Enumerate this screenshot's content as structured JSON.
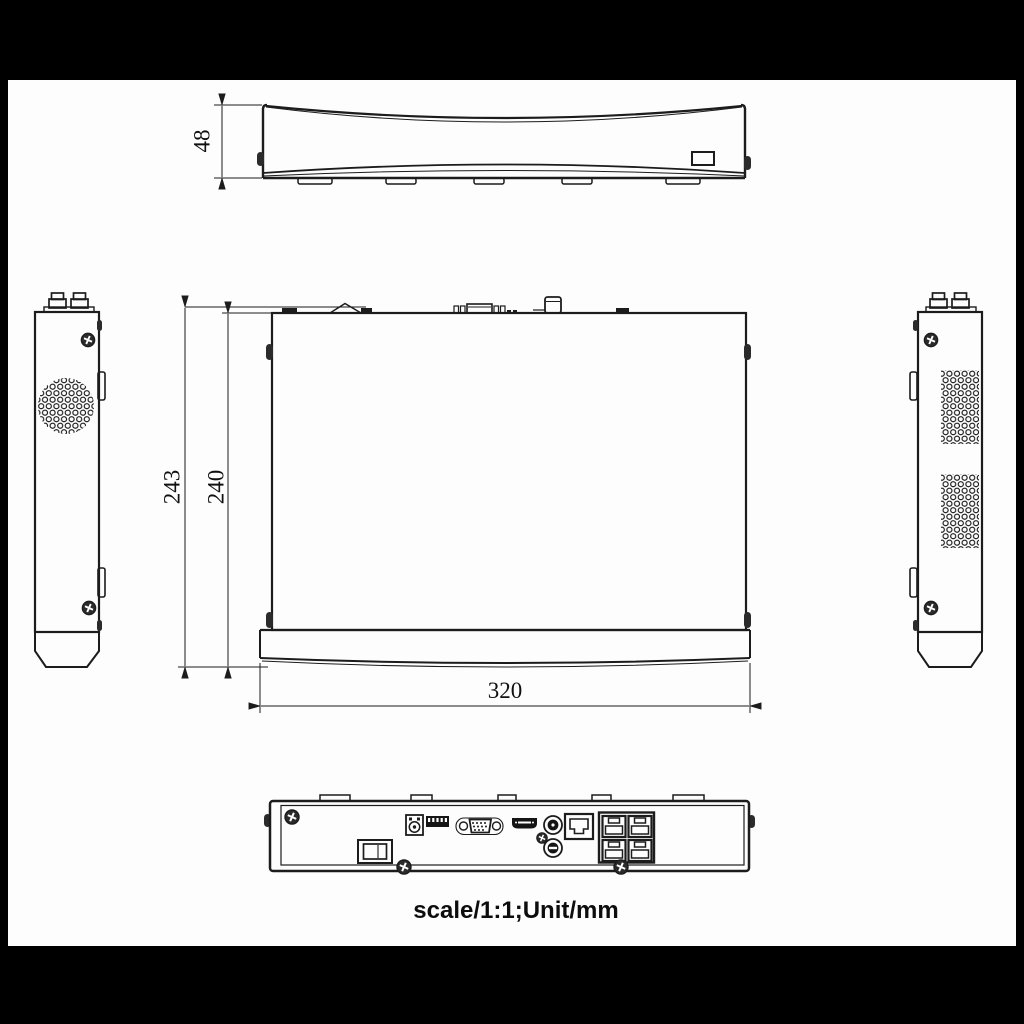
{
  "caption": "scale/1:1;Unit/mm",
  "dims": {
    "front_height": "48",
    "overall_depth": "243",
    "body_depth": "240",
    "body_width": "320"
  },
  "colors": {
    "letterbox_background": "#000000",
    "paper": "#fdfdfd",
    "line": "#1c1c1c"
  },
  "views": [
    {
      "id": "front-view",
      "label": "front elevation with height dimension"
    },
    {
      "id": "top-view",
      "label": "plan view with depth and width dimensions"
    },
    {
      "id": "left-side-view",
      "label": "left side elevation with round vent"
    },
    {
      "id": "right-side-view",
      "label": "right side elevation with vent grids"
    },
    {
      "id": "rear-view",
      "label": "rear panel with connectors"
    }
  ],
  "rear_ports": [
    "screw",
    "power-switch",
    "dc-power-jack",
    "terminal-block",
    "vga-port",
    "hdmi-port",
    "audio-rca-jack",
    "audio-rca-jack",
    "lan-rj45-port",
    "poe-rj45-block-2x2"
  ]
}
